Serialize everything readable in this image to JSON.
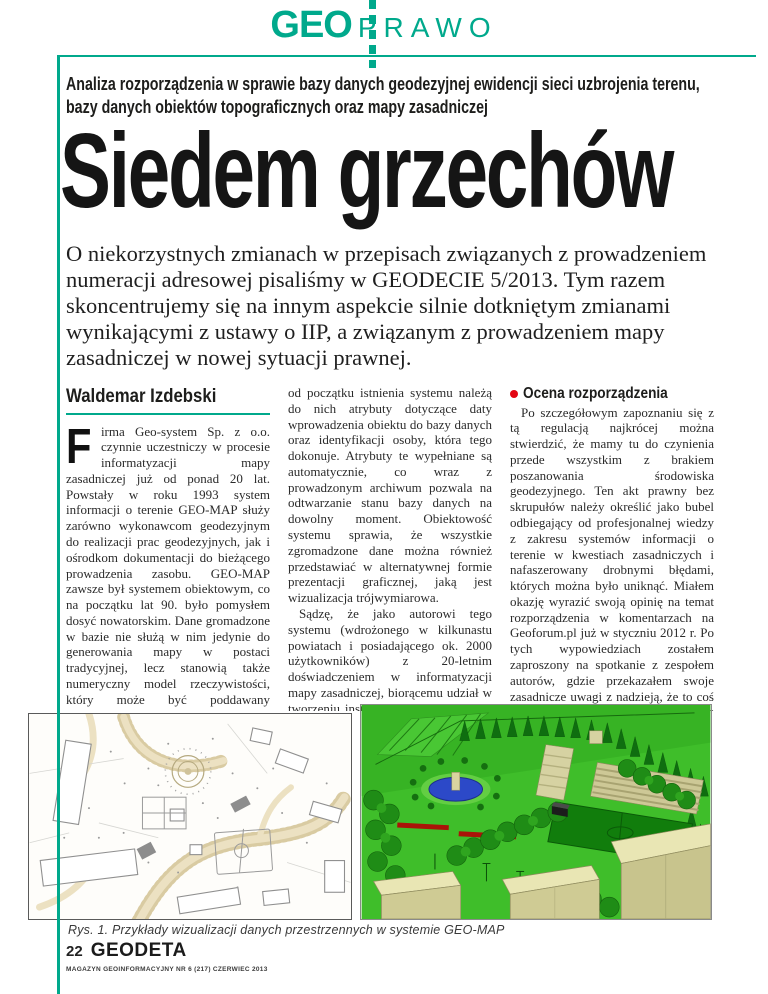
{
  "page": {
    "colors": {
      "accent_teal": "#00a98c",
      "bullet_red": "#e30613"
    }
  },
  "header": {
    "logo_geo": "GEO",
    "logo_prawo": "PRAWO"
  },
  "kicker": "Analiza rozporządzenia w sprawie bazy danych geodezyjnej ewidencji sieci uzbrojenia terenu, bazy danych obiektów topograficznych oraz mapy zasadniczej",
  "headline": "Siedem grzechów",
  "lead": "O niekorzystnych zmianach w przepisach związanych z prowadzeniem numeracji adresowej pisaliśmy w GEODECIE 5/2013. Tym razem skoncentrujemy się na innym aspekcie silnie dotkniętym zmianami wynikającymi z ustawy o IIP, a związanym z prowadzeniem mapy zasadniczej w nowej sytuacji prawnej.",
  "author": "Waldemar Izdebski",
  "col1": {
    "dropcap": "F",
    "p1": "irma Geo-system Sp. z o.o. czynnie uczestniczy w procesie informatyzacji mapy zasadniczej już od ponad 20 lat. Powstały w roku 1993 system informacji o terenie GEO-MAP służy zarówno wykonawcom geodezyjnym do realizacji prac geodezyjnych, jak i ośrodkom dokumentacji do bieżącego prowadzenia zasobu. GEO-MAP zawsze był systemem obiektowym, co na początku lat 90. było pomysłem dosyć nowatorskim. Dane gromadzone w bazie nie służą w nim jedynie do generowania mapy w postaci tradycyjnej, lecz stanowią także numeryczny model rzeczywistości, który może być poddawany przetwarzaniu i analizie.",
    "p2": "Z każdym obiektem oprócz atrybutów przestrzennych dotyczących położenia i kształtu (współrzędne) związanych jest wiele atrybutów opisowych. Praktycznie"
  },
  "col2": {
    "p1": "od początku istnienia systemu należą do nich atrybuty dotyczące daty wprowadzenia obiektu do bazy danych oraz identyfikacji osoby, która tego dokonuje. Atrybuty te wypełniane są automatycznie, co wraz z prowadzonym archiwum pozwala na odtwarzanie stanu bazy danych na dowolny moment. Obiektowość systemu sprawia, że wszystkie zgromadzone dane można również przedstawiać w alternatywnej formie prezentacji graficznej, jaką jest wizualizacja trójwymiarowa.",
    "p2_normal": "Sądzę, że jako autorowi tego systemu (wdrożonego w kilkunastu powiatach i posiadającego ok. 2000 użytkowników) z 20-letnim doświadczeniem w informatyzacji mapy zasadniczej, biorącemu udział w tworzeniu instrukcji K1 w roku 1994, przysługuje mi prawo do wypowiedzenia się na temat rozporządzenia ",
    "p2_italic": "ws. bazy danych geodezyjnej ewidencji sieci uzbrojenia terenu, bazy danych obiektów topograficznych oraz mapy zasadniczej",
    "p2_tail": " [1]."
  },
  "col3": {
    "heading": "Ocena rozporządzenia",
    "p1": "Po szczegółowym zapoznaniu się z tą regulacją najkrócej można stwierdzić, że mamy tu do czynienia przede wszystkim z brakiem poszanowania środowiska geodezyjnego. Ten akt prawny bez skrupułów należy określić jako bubel odbiegający od profesjonalnej wiedzy z zakresu systemów informacji o terenie w kwestiach zasadniczych i nafaszerowany drobnymi błędami, których można było uniknąć. Miałem okazję wyrazić swoją opinię na temat rozporządzenia w komentarzach na Geoforum.pl już w styczniu 2012 r. Po tych wypowiedziach zostałem zaproszony na spotkanie z zespołem autorów, gdzie przekazałem swoje zasadnicze uwagi z nadzieją, że to coś zmieni. Niestety, rozporządzenie zostało opublikowane praktycznie w niezmienionej postaci. Uważam nadal, że regulacja ta – w kontekście merytorycznego podejścia do prowadzenia mapy zasadniczej – jest bardzo zła i cofa"
  },
  "figure": {
    "caption": "Rys. 1. Przykłady wizualizacji danych przestrzennych w systemie GEO-MAP"
  },
  "footer": {
    "page_number": "22",
    "logo": "GEODETA",
    "issue_line": "MAGAZYN GEOINFORMACYJNY NR 6 (217) CZERWIEC 2013"
  }
}
